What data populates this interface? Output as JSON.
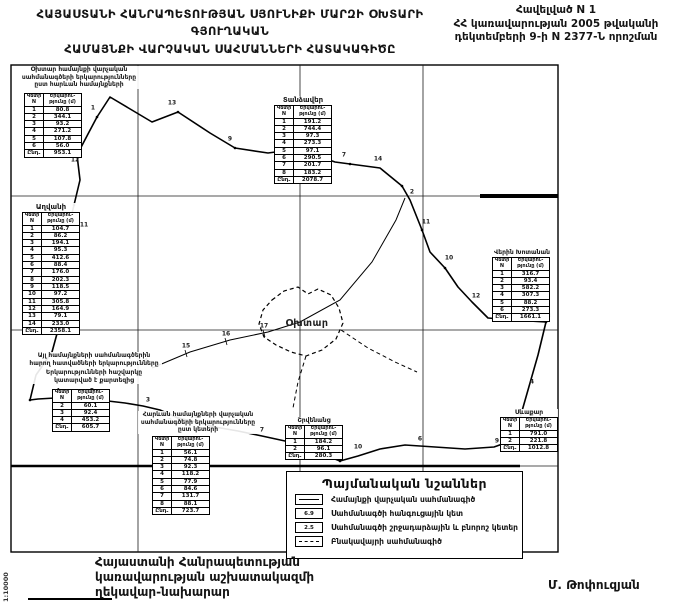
{
  "header": {
    "title_line1": "ՀԱՅԱՍՏԱՆԻ ՀԱՆՐԱՊԵՏՈՒԹՅԱՆ ՍՅՈՒՆԻՔԻ ՄԱՐԶԻ ՕԽՏԱՐԻ ԳՅՈՒՂԱԿԱՆ",
    "title_line2": "ՀԱՄԱՅՆՔԻ ՎԱՐՉԱԿԱՆ ՍԱՀՄԱՆՆԵՐԻ ՀԱՏԱԿԱԳԻԾԸ",
    "annex_line1": "Հավելված N 1",
    "annex_line2": "ՀՀ կառավարության 2005 թվականի",
    "annex_line3": "դեկտեմբերի 9-ի N 2377-Ն որոշման"
  },
  "map": {
    "settlement_label": "Օխտար",
    "scale_label": "1:10000"
  },
  "tables": {
    "t1": {
      "title_lines": [
        "Օխտար համայնքի վարչական",
        "սահմանագծերի երկարությունները",
        "ըստ հարևան համայնքների"
      ],
      "col1": "Կետի N",
      "col2": "Երկարու- թյունը (մ)",
      "rows": [
        [
          "1",
          "80.8"
        ],
        [
          "2",
          "344.1"
        ],
        [
          "3",
          "93.2"
        ],
        [
          "4",
          "271.2"
        ],
        [
          "5",
          "107.8"
        ],
        [
          "6",
          "56.0"
        ]
      ],
      "total_label": "Ընդ.",
      "total_value": "953.1"
    },
    "t2": {
      "title": "Տանձավեր",
      "col1": "Կետի N",
      "col2": "Երկարու- թյունը (մ)",
      "rows": [
        [
          "1",
          "191.2"
        ],
        [
          "2",
          "744.4"
        ],
        [
          "3",
          "97.3"
        ],
        [
          "4",
          "273.3"
        ],
        [
          "5",
          "97.1"
        ],
        [
          "6",
          "290.5"
        ],
        [
          "7",
          "201.7"
        ],
        [
          "8",
          "183.2"
        ]
      ],
      "total_label": "Ընդ.",
      "total_value": "2078.7"
    },
    "t3": {
      "title": "Աղվանի",
      "col1": "Կետի N",
      "col2": "Երկարու- թյունը (մ)",
      "rows": [
        [
          "1",
          "104.7"
        ],
        [
          "2",
          "86.2"
        ],
        [
          "3",
          "194.1"
        ],
        [
          "4",
          "95.3"
        ],
        [
          "5",
          "412.6"
        ],
        [
          "6",
          "88.4"
        ],
        [
          "7",
          "176.0"
        ],
        [
          "8",
          "202.3"
        ],
        [
          "9",
          "118.5"
        ],
        [
          "10",
          "97.2"
        ],
        [
          "11",
          "305.8"
        ],
        [
          "12",
          "164.9"
        ],
        [
          "13",
          "79.1"
        ],
        [
          "14",
          "233.0"
        ]
      ],
      "total_label": "Ընդ.",
      "total_value": "2358.1"
    },
    "t4": {
      "title": "Վերին Խոտանան",
      "col1": "Կետի N",
      "col2": "Երկարու- թյունը (մ)",
      "rows": [
        [
          "1",
          "316.7"
        ],
        [
          "2",
          "93.4"
        ],
        [
          "3",
          "582.2"
        ],
        [
          "4",
          "307.3"
        ],
        [
          "5",
          "88.2"
        ],
        [
          "6",
          "273.3"
        ]
      ],
      "total_label": "Ընդ.",
      "total_value": "1661.1"
    },
    "t5": {
      "note_lines": [
        "Այլ համայնքների սահմանագծերին",
        "հարող հատվածների երկարությունները",
        "Երկարությունների հաշվարկը",
        "կատարված է քարտեզից"
      ],
      "col1": "Կետի N",
      "col2": "Երկարու- թյունը (մ)",
      "rows": [
        [
          "2",
          "60.1"
        ],
        [
          "3",
          "92.4"
        ],
        [
          "4",
          "453.2"
        ]
      ],
      "total_label": "Ընդ.",
      "total_value": "605.7"
    },
    "t6": {
      "title_lines": [
        "Հարևան համայնքների վարչական",
        "սահմանագծերի երկարությունները",
        "ըստ կետերի"
      ],
      "col1": "Կետի N",
      "col2": "Երկարու- թյունը (մ)",
      "rows": [
        [
          "1",
          "56.1"
        ],
        [
          "2",
          "74.8"
        ],
        [
          "3",
          "92.3"
        ],
        [
          "4",
          "118.2"
        ],
        [
          "5",
          "77.9"
        ],
        [
          "6",
          "84.6"
        ],
        [
          "7",
          "131.7"
        ],
        [
          "8",
          "88.1"
        ]
      ],
      "total_label": "Ընդ.",
      "total_value": "723.7"
    },
    "t7": {
      "title": "Շրվենանց",
      "col1": "Կետի N",
      "col2": "Երկարու- թյունը (մ)",
      "rows": [
        [
          "1",
          "184.2"
        ],
        [
          "2",
          "96.1"
        ]
      ],
      "total_label": "Ընդ.",
      "total_value": "280.3"
    },
    "t8": {
      "title": "Սևաքար",
      "col1": "Կետի N",
      "col2": "Երկարու- թյունը (մ)",
      "rows": [
        [
          "1",
          "791.0"
        ],
        [
          "2",
          "221.8"
        ]
      ],
      "total_label": "Ընդ.",
      "total_value": "1012.8"
    }
  },
  "legend": {
    "title": "Պայմանական նշաններ",
    "items": [
      {
        "symbol": "solid-line",
        "text": "",
        "label": "Համայնքի վարչական սահմանագիծ"
      },
      {
        "symbol": "node-point",
        "text": "6.9",
        "label": "Սահմանագծի հանգուցային կետ"
      },
      {
        "symbol": "turn-point",
        "text": "2.5",
        "label": "Սահմանագծի շրջադարձային և բնորոշ կետեր"
      },
      {
        "symbol": "dashed-line",
        "text": "",
        "label": "Բնակավայրի սահմանագիծ"
      }
    ]
  },
  "footer": {
    "office_line1": "Հայաստանի Հանրապետության",
    "office_line2": "կառավարության աշխատակազմի",
    "office_line3": "ղեկավար-նախարար",
    "signature": "Մ. Թոփուզյան"
  },
  "point_labels": [
    {
      "x": 93,
      "y": 108,
      "t": "1"
    },
    {
      "x": 172,
      "y": 103,
      "t": "13"
    },
    {
      "x": 230,
      "y": 139,
      "t": "9"
    },
    {
      "x": 294,
      "y": 140,
      "t": "8"
    },
    {
      "x": 344,
      "y": 155,
      "t": "7"
    },
    {
      "x": 378,
      "y": 159,
      "t": "14"
    },
    {
      "x": 412,
      "y": 192,
      "t": "2"
    },
    {
      "x": 426,
      "y": 222,
      "t": "11"
    },
    {
      "x": 449,
      "y": 258,
      "t": "10"
    },
    {
      "x": 476,
      "y": 296,
      "t": "12"
    },
    {
      "x": 549,
      "y": 316,
      "t": "3"
    },
    {
      "x": 532,
      "y": 382,
      "t": "4"
    },
    {
      "x": 520,
      "y": 416,
      "t": "5"
    },
    {
      "x": 497,
      "y": 441,
      "t": "9"
    },
    {
      "x": 420,
      "y": 439,
      "t": "6"
    },
    {
      "x": 358,
      "y": 447,
      "t": "10"
    },
    {
      "x": 322,
      "y": 447,
      "t": "12"
    },
    {
      "x": 337,
      "y": 453,
      "t": "13"
    },
    {
      "x": 262,
      "y": 430,
      "t": "7"
    },
    {
      "x": 196,
      "y": 416,
      "t": "1"
    },
    {
      "x": 170,
      "y": 421,
      "t": "2"
    },
    {
      "x": 148,
      "y": 400,
      "t": "3"
    },
    {
      "x": 92,
      "y": 391,
      "t": "5"
    },
    {
      "x": 58,
      "y": 391,
      "t": "4"
    },
    {
      "x": 75,
      "y": 160,
      "t": "12"
    },
    {
      "x": 84,
      "y": 225,
      "t": "11"
    },
    {
      "x": 146,
      "y": 361,
      "t": "4"
    },
    {
      "x": 186,
      "y": 346,
      "t": "15"
    },
    {
      "x": 226,
      "y": 334,
      "t": "16"
    },
    {
      "x": 264,
      "y": 326,
      "t": "17"
    }
  ]
}
